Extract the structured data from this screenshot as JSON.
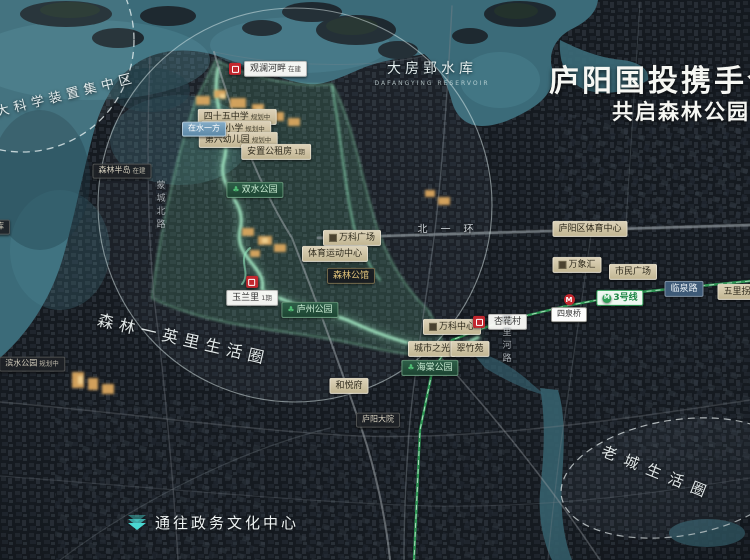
{
  "header": {
    "title_line1": "庐阳国投携手合作",
    "title_line2": "共启森林公园2.0时代"
  },
  "landmarks": {
    "reservoir_cn": "大房郢水库",
    "reservoir_en": "DAFANGYING RESERVOIR"
  },
  "zones": [
    {
      "name": "zone-science-cluster",
      "label": "大科学装置集中区",
      "x": -6,
      "y": 84,
      "rot": -14,
      "spacing": 5,
      "size": 13
    },
    {
      "name": "zone-forest-mile",
      "label": "森林一英里生活圈",
      "x": 96,
      "y": 326,
      "rot": 13,
      "spacing": 6,
      "size": 16
    },
    {
      "name": "zone-old-town",
      "label": "老城生活圈",
      "x": 598,
      "y": 462,
      "rot": 22,
      "spacing": 9,
      "size": 15
    }
  ],
  "footer_note": "通往政务文化中心",
  "map_labels": [
    {
      "name": "label-guanlan-hepan",
      "text": "观澜河畔",
      "tag": "在建",
      "type": "project",
      "x": 268,
      "y": 69
    },
    {
      "name": "label-45-middle-school",
      "text": "四十五中学",
      "tag": "规划中",
      "type": "tan",
      "x": 237,
      "y": 117
    },
    {
      "name": "label-experimental-primary",
      "text": "实验小学",
      "tag": "规划中",
      "type": "tan",
      "x": 236,
      "y": 129
    },
    {
      "name": "label-kindergarten",
      "text": "第六幼儿园",
      "tag": "规划中",
      "type": "tan",
      "x": 238,
      "y": 140
    },
    {
      "name": "label-zaishuiyifang",
      "text": "在水一方",
      "tag": "",
      "type": "blue",
      "x": 204,
      "y": 129
    },
    {
      "name": "label-public-housing",
      "text": "安置公租房",
      "tag": "1期",
      "type": "tan",
      "x": 276,
      "y": 152
    },
    {
      "name": "label-senlin-bandao",
      "text": "森林半岛",
      "tag": "在建",
      "type": "dark",
      "x": 122,
      "y": 171
    },
    {
      "name": "label-shuangshui-park",
      "text": "双水公园",
      "tag": "",
      "type": "park",
      "icon": "tree",
      "x": 255,
      "y": 190
    },
    {
      "name": "label-road-mengchengbeilu",
      "text": "蒙城北路",
      "tag": "",
      "type": "roadtext-v",
      "x": 160,
      "y": 206
    },
    {
      "name": "label-road-beiyihuan",
      "text": "北一环",
      "tag": "",
      "type": "roadtext-h",
      "x": 452,
      "y": 228
    },
    {
      "name": "label-wanke-plaza",
      "text": "万科广场",
      "tag": "",
      "type": "tan",
      "icon": "building",
      "x": 352,
      "y": 238
    },
    {
      "name": "label-sports-center",
      "text": "体育运动中心",
      "tag": "",
      "type": "tan",
      "x": 335,
      "y": 254
    },
    {
      "name": "label-senlin-gongguan",
      "text": "森林公馆",
      "tag": "",
      "type": "dark-gold",
      "x": 351,
      "y": 276
    },
    {
      "name": "label-yulanli",
      "text": "玉兰里",
      "tag": "1期",
      "type": "project-stack",
      "x": 252,
      "y": 291
    },
    {
      "name": "label-luzhou-park",
      "text": "庐州公园",
      "tag": "",
      "type": "park",
      "icon": "tree",
      "x": 310,
      "y": 310
    },
    {
      "name": "label-reservoir-west",
      "text": "水库",
      "tag": "",
      "type": "dark",
      "x": -4,
      "y": 227
    },
    {
      "name": "label-binshui-park",
      "text": "滨水公园",
      "tag": "规划中",
      "type": "dark",
      "x": 32,
      "y": 364
    },
    {
      "name": "label-luyang-sports-center",
      "text": "庐阳区体育中心",
      "tag": "",
      "type": "tan",
      "x": 590,
      "y": 229
    },
    {
      "name": "label-wanxianghui",
      "text": "万象汇",
      "tag": "",
      "type": "tan",
      "icon": "building",
      "x": 577,
      "y": 265
    },
    {
      "name": "label-shimin-plaza",
      "text": "市民广场",
      "tag": "",
      "type": "tan",
      "x": 633,
      "y": 272
    },
    {
      "name": "label-road-linquan",
      "text": "临泉路",
      "tag": "",
      "type": "road",
      "x": 684,
      "y": 289
    },
    {
      "name": "label-metro-line3",
      "text": "3号线",
      "tag": "",
      "type": "metro-line",
      "x": 620,
      "y": 298
    },
    {
      "name": "label-station-siquanqiao",
      "text": "四泉桥",
      "tag": "",
      "type": "station",
      "x": 569,
      "y": 308
    },
    {
      "name": "label-wulipai",
      "text": "五里拐",
      "tag": "",
      "type": "tan",
      "x": 737,
      "y": 292
    },
    {
      "name": "label-wanke-center",
      "text": "万科中心",
      "tag": "",
      "type": "tan",
      "icon": "building",
      "x": 452,
      "y": 327
    },
    {
      "name": "label-xinghuacun",
      "text": "杏花村",
      "tag": "",
      "type": "project",
      "x": 500,
      "y": 322
    },
    {
      "name": "label-road-silihelu",
      "text": "四里河路",
      "tag": "",
      "type": "roadtext-v",
      "x": 506,
      "y": 340
    },
    {
      "name": "label-chengshizhiguang",
      "text": "城市之光",
      "tag": "",
      "type": "tan",
      "x": 432,
      "y": 349
    },
    {
      "name": "label-cuizhuyuan",
      "text": "翠竹苑",
      "tag": "",
      "type": "tan",
      "x": 470,
      "y": 349
    },
    {
      "name": "label-haitang-park",
      "text": "海棠公园",
      "tag": "",
      "type": "park",
      "icon": "tree",
      "x": 430,
      "y": 368
    },
    {
      "name": "label-heyuefu",
      "text": "和悦府",
      "tag": "",
      "type": "tan",
      "x": 349,
      "y": 386
    },
    {
      "name": "label-luyang-dayuan",
      "text": "庐阳大院",
      "tag": "",
      "type": "dark",
      "x": 378,
      "y": 420
    }
  ],
  "colors": {
    "background": "#151a20",
    "water": "#3b6b79",
    "park_glow": "#9ff0c4",
    "label_tan": "#cfc3a6",
    "logo_red": "#c2272e",
    "metro_green": "#2f9e57",
    "title_white": "#f6f7f3",
    "note_teal": "#4ad8d2"
  }
}
